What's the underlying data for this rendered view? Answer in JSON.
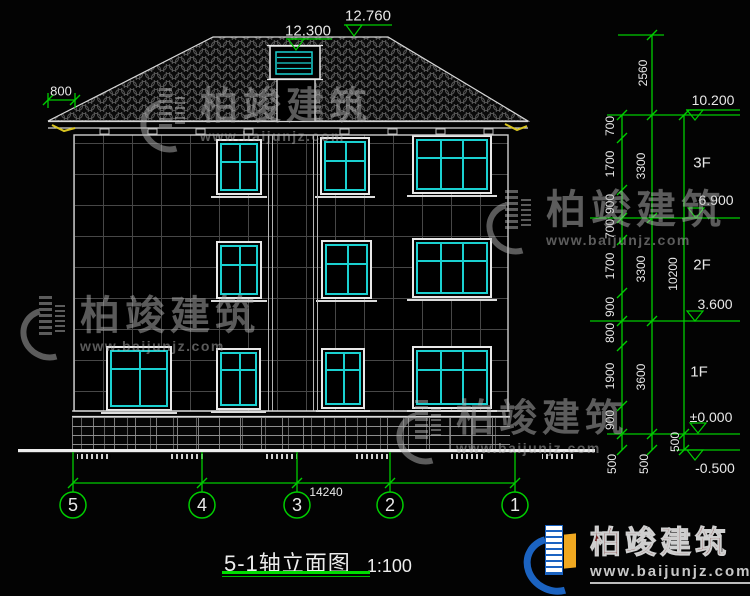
{
  "title": {
    "name": "5-1轴立面图",
    "scale": "1:100"
  },
  "dimensions": {
    "eave_overhang": "800",
    "total_width": "14240",
    "dormer_top": "12.300",
    "ridge_top": "12.760",
    "inner_chain": [
      "700",
      "1700",
      "900",
      "700",
      "1700",
      "900",
      "800",
      "1900",
      "900",
      "500"
    ],
    "middle_chain": [
      "2560",
      "3300",
      "3300",
      "3600",
      "500"
    ],
    "outer_chain": [
      "10200",
      "500"
    ]
  },
  "levels": {
    "marks": [
      "10.200",
      "6.900",
      "3.600",
      "±0.000",
      "-0.500"
    ],
    "floors": [
      "3F",
      "2F",
      "1F"
    ]
  },
  "axes": [
    "5",
    "4",
    "3",
    "2",
    "1"
  ],
  "watermark": {
    "brand": "柏竣建筑",
    "url": "www.baijunjz.com"
  },
  "footer": {
    "brand": "柏竣建筑",
    "url": "www.baijunjz.com"
  },
  "colors": {
    "dimension_green": "#00cc00",
    "window_cyan": "#1ad1d1",
    "line_white": "#e0e0e0",
    "gutter_yellow": "#d8c420",
    "brand_red": "#6e1e1e",
    "logo_blue": "#1b63c1",
    "logo_orange": "#f0a820",
    "watermark_gray": "#b4b4b4"
  }
}
